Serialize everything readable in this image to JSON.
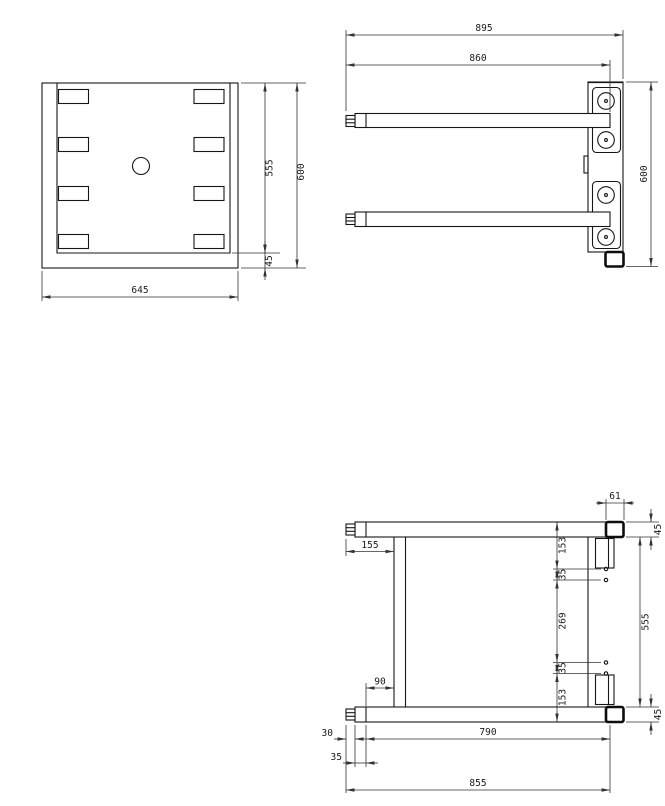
{
  "views": {
    "front": {
      "label_width": "645",
      "label_plate_height": "555",
      "label_overall_height": "600",
      "label_base_gap": "45"
    },
    "side": {
      "label_overall_depth": "895",
      "label_fork_length": "860",
      "label_overall_height": "600"
    },
    "plan": {
      "label_pad_width": "61",
      "label_fork_thickness_top": "45",
      "label_pad_len_top": "153",
      "label_hole_gap_top": "35",
      "label_pad_spacing": "269",
      "label_hole_gap_bottom": "35",
      "label_pad_len_bottom": "153",
      "label_inner_height": "555",
      "label_fork_thickness_bottom": "45",
      "label_tip_to_cross": "155",
      "label_collar_to_cross": "90",
      "label_tip_len": "30",
      "label_collar_len": "35",
      "label_body_len": "790",
      "label_overall_len": "855"
    }
  }
}
